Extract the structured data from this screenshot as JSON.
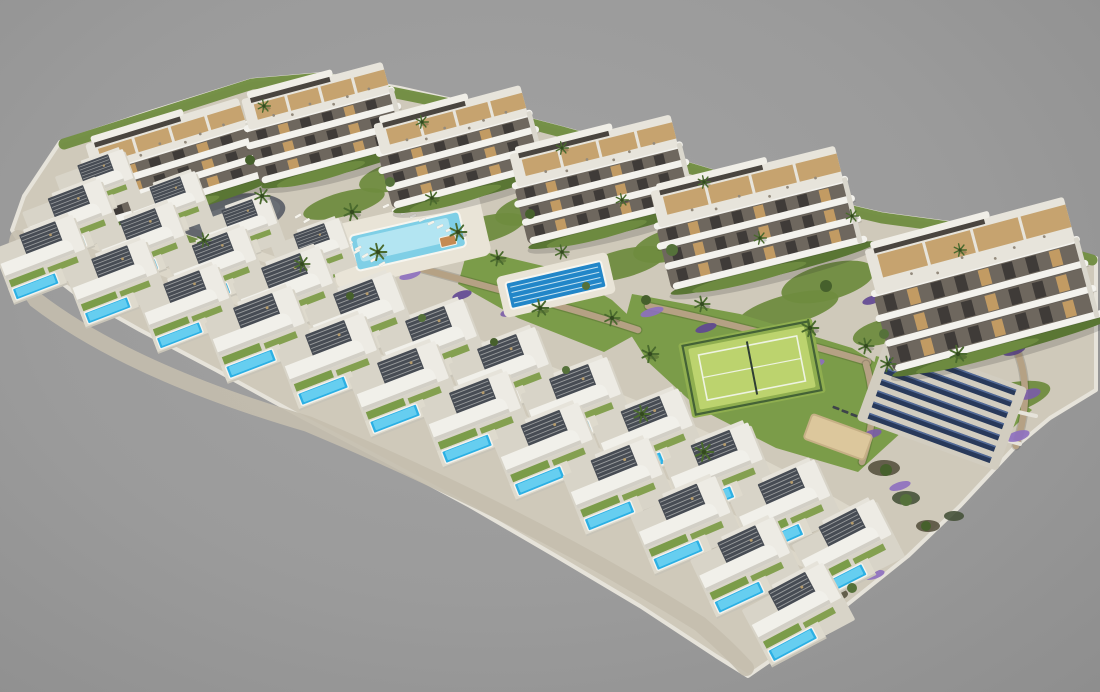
{
  "scene": {
    "description": "Aerial 3D architectural render of a hillside residential development on a plain gray backdrop: six curved white apartment buildings in a diagonal row, two long staircased arcs of white villas each with a private blue pool and dark slatted pergola, a communal free-form pool with sun loungers, a dark-blue lap pool, a fenced padel tennis court on a lawn, a gray playground oval with colorful equipment, a sand petanque area and a field of dark solar panels at the right",
    "background": {
      "center": "#a3a3a3",
      "mid": "#9b9b9b",
      "edge": "#8e8e8e"
    },
    "palette": {
      "land": "#cfc9ba",
      "land_edge": "#e6e3da",
      "cliff": "#c4beae",
      "building_white": "#f3f2ed",
      "building_facade": "#6e675e",
      "glass": "#3f3b38",
      "wood": "#c29b63",
      "roof_deck": "#e7e4db",
      "hedge": "#5a7634",
      "hedge_light": "#6d8a40",
      "lawn": "#7b9c49",
      "garden": "#6f8c3f",
      "palm": "#4a6a2e",
      "palm_dark": "#33491f",
      "villa_white": "#f1f0ea",
      "villa_shade": "#d2cfc6",
      "villa_wing": "#edebe4",
      "pergola": "#474c54",
      "plot": "#d8d4c8",
      "deck": "#e9e4d7",
      "pool": "#2cb0e4",
      "pool_light": "#71d3f2",
      "main_pool": "#7fcfe6",
      "main_pool_light": "#bce9f3",
      "lap_pool": "#2286c8",
      "lap_pool_lane": "#dff2f8",
      "stone_wall": "#b5a184",
      "path": "#ddd8cb",
      "lavender": [
        "#7a5ca8",
        "#8d6fc0",
        "#5f4694"
      ],
      "tennis_court": "#bcd36e",
      "tennis_runoff": "#8fae4f",
      "tennis_fence": "#3c5a33",
      "court_line": "#eef3e2",
      "sand": "#dcc79c",
      "sand_edge": "#c6b086",
      "solar": "#28395a",
      "solar_hl": "#5d77a8",
      "solar_pad": "#d2cdc0",
      "playground": "#63666d",
      "playground_light": "#70747c",
      "rock1": "#57523f",
      "rock2": "#46523a",
      "shadow": "rgba(40,40,40,0.18)",
      "cabana_roof": "#c58a52"
    },
    "land_outline": [
      [
        60,
        142
      ],
      [
        150,
        112
      ],
      [
        252,
        80
      ],
      [
        322,
        74
      ],
      [
        400,
        88
      ],
      [
        470,
        104
      ],
      [
        562,
        128
      ],
      [
        642,
        150
      ],
      [
        762,
        186
      ],
      [
        882,
        214
      ],
      [
        1002,
        230
      ],
      [
        1096,
        258
      ],
      [
        1096,
        390
      ],
      [
        1050,
        418
      ],
      [
        1014,
        448
      ],
      [
        960,
        506
      ],
      [
        908,
        556
      ],
      [
        838,
        612
      ],
      [
        774,
        658
      ],
      [
        748,
        676
      ],
      [
        716,
        656
      ],
      [
        640,
        606
      ],
      [
        556,
        556
      ],
      [
        470,
        506
      ],
      [
        384,
        460
      ],
      [
        300,
        416
      ],
      [
        216,
        370
      ],
      [
        140,
        330
      ],
      [
        76,
        294
      ],
      [
        30,
        258
      ],
      [
        12,
        230
      ],
      [
        24,
        196
      ]
    ],
    "cliff_path": "M18,238 Q10,262 36,300 Q130,372 308,424 Q528,516 700,624 Q728,648 746,668",
    "top_hedge": "M64,144 L252,84 L322,78 L470,108 L562,132 L642,154 L762,190 L882,218 L1002,234 L1092,260",
    "buildings": [
      [
        92,
        116,
        166,
        98,
        -17
      ],
      [
        248,
        76,
        152,
        102,
        -15
      ],
      [
        380,
        100,
        158,
        102,
        -15
      ],
      [
        516,
        130,
        172,
        108,
        -14
      ],
      [
        658,
        164,
        196,
        118,
        -14
      ],
      [
        876,
        218,
        212,
        146,
        -15
      ]
    ],
    "villas": [
      [
        98,
        186,
        -20,
        0.78
      ],
      [
        170,
        208,
        -20,
        0.78
      ],
      [
        242,
        231,
        -20,
        0.78
      ],
      [
        314,
        255,
        -20,
        0.78
      ],
      [
        72,
        222,
        -21,
        0.9
      ],
      [
        144,
        245,
        -21,
        0.9
      ],
      [
        216,
        269,
        -21,
        0.9
      ],
      [
        288,
        294,
        -21,
        1
      ],
      [
        360,
        320,
        -21,
        1
      ],
      [
        432,
        347,
        -21,
        1
      ],
      [
        504,
        375,
        -21,
        1
      ],
      [
        576,
        405,
        -21,
        1
      ],
      [
        648,
        437,
        -22,
        1
      ],
      [
        718,
        471,
        -22,
        1
      ],
      [
        786,
        509,
        -24,
        1
      ],
      [
        848,
        550,
        -27,
        1
      ],
      [
        44,
        259,
        -21,
        0.92
      ],
      [
        116,
        283,
        -21,
        0.92
      ],
      [
        188,
        308,
        -21,
        0.92
      ],
      [
        260,
        334,
        -21,
        1
      ],
      [
        332,
        361,
        -21,
        1
      ],
      [
        404,
        389,
        -21,
        1
      ],
      [
        476,
        419,
        -21,
        1
      ],
      [
        548,
        451,
        -22,
        1
      ],
      [
        618,
        486,
        -22,
        1
      ],
      [
        686,
        525,
        -23,
        1
      ],
      [
        746,
        567,
        -25,
        1
      ],
      [
        798,
        614,
        -28,
        1
      ]
    ],
    "paths": [
      "M104,202 Q240,248 354,290",
      "M82,240 Q360,346 642,472 Q724,510 802,562",
      "M138,232 Q416,314 638,406 Q760,458 868,522"
    ],
    "walls": [
      "M128,244 Q400,330 620,424 Q742,478 858,542",
      "M300,236 Q420,268 522,296 Q584,312 638,330",
      "M648,306 Q760,330 868,362",
      "M1006,330 Q1038,378 1016,446",
      "M866,364 Q880,410 862,462"
    ],
    "white_walls": [
      "M884,366 Q960,400 1036,416",
      "M872,390 Q950,424 1020,444"
    ],
    "lawns": [
      {
        "type": "poly",
        "pts": [
          [
            632,
            294
          ],
          [
            740,
            314
          ],
          [
            852,
            348
          ],
          [
            900,
            378
          ],
          [
            904,
            430
          ],
          [
            858,
            472
          ],
          [
            776,
            448
          ],
          [
            698,
            408
          ],
          [
            648,
            362
          ],
          [
            624,
            324
          ]
        ]
      },
      {
        "type": "poly",
        "pts": [
          [
            468,
            248
          ],
          [
            560,
            270
          ],
          [
            612,
            300
          ],
          [
            644,
            330
          ],
          [
            604,
            352
          ],
          [
            518,
            318
          ],
          [
            458,
            284
          ]
        ]
      },
      {
        "type": "poly",
        "pts": [
          [
            876,
            356
          ],
          [
            1000,
            388
          ],
          [
            1032,
            410
          ],
          [
            1002,
            438
          ],
          [
            926,
            416
          ],
          [
            868,
            388
          ]
        ]
      },
      {
        "type": "ellipse",
        "cx": 334,
        "cy": 262,
        "rx": 44,
        "ry": 15,
        "rot": -15
      }
    ],
    "gardens": [
      [
        256,
        152,
        38,
        14
      ],
      [
        396,
        176,
        38,
        14
      ],
      [
        534,
        208,
        40,
        15
      ],
      [
        674,
        244,
        42,
        16
      ],
      [
        828,
        282,
        48,
        18
      ],
      [
        882,
        332,
        30,
        12
      ],
      [
        198,
        228,
        44,
        13
      ],
      [
        344,
        204,
        42,
        12
      ],
      [
        482,
        230,
        44,
        13
      ],
      [
        622,
        264,
        46,
        14
      ],
      [
        788,
        310,
        52,
        15
      ],
      [
        996,
        402,
        56,
        16
      ]
    ],
    "lavender": [
      [
        140,
        252,
        14,
        5,
        0
      ],
      [
        198,
        269,
        12,
        4,
        1
      ],
      [
        256,
        288,
        14,
        5,
        2
      ],
      [
        314,
        307,
        12,
        4,
        0
      ],
      [
        372,
        327,
        13,
        5,
        1
      ],
      [
        430,
        348,
        12,
        4,
        2
      ],
      [
        488,
        371,
        14,
        5,
        0
      ],
      [
        546,
        395,
        12,
        4,
        1
      ],
      [
        602,
        420,
        13,
        5,
        2
      ],
      [
        658,
        447,
        12,
        4,
        0
      ],
      [
        714,
        477,
        13,
        5,
        1
      ],
      [
        768,
        508,
        12,
        4,
        2
      ],
      [
        822,
        541,
        13,
        5,
        0
      ],
      [
        874,
        575,
        11,
        4,
        1
      ],
      [
        306,
        238,
        11,
        4,
        2
      ],
      [
        358,
        256,
        10,
        4,
        0
      ],
      [
        410,
        275,
        11,
        4,
        1
      ],
      [
        462,
        295,
        10,
        4,
        2
      ],
      [
        510,
        312,
        10,
        4,
        0
      ],
      [
        652,
        312,
        12,
        4,
        1
      ],
      [
        706,
        328,
        11,
        4,
        2
      ],
      [
        760,
        346,
        12,
        4,
        0
      ],
      [
        814,
        364,
        11,
        4,
        1
      ],
      [
        1014,
        350,
        12,
        5,
        2
      ],
      [
        1030,
        394,
        11,
        5,
        0
      ],
      [
        1018,
        436,
        12,
        5,
        1
      ],
      [
        880,
        390,
        10,
        4,
        2
      ],
      [
        872,
        434,
        10,
        4,
        0
      ],
      [
        900,
        486,
        11,
        4,
        1
      ],
      [
        872,
        300,
        10,
        4,
        2
      ],
      [
        930,
        318,
        10,
        4,
        0
      ]
    ],
    "amenities": {
      "playground": {
        "cx": 232,
        "cy": 216,
        "rx": 54,
        "ry": 21,
        "rot": -10,
        "equipment_colors": [
          "#e0b13c",
          "#d96c2f",
          "#4a8fd4",
          "#c94f4f",
          "#7fb548"
        ]
      },
      "main_pool": {
        "cx": 408,
        "cy": 241,
        "w": 112,
        "h": 36,
        "rot": -13,
        "deck_w": 158,
        "deck_h": 64
      },
      "cabana": {
        "cx": 447,
        "cy": 250,
        "w": 16,
        "h": 10,
        "rot": -13
      },
      "lap_pool": {
        "cx": 556,
        "cy": 285,
        "w": 98,
        "h": 27,
        "rot": -13,
        "deck_w": 114,
        "deck_h": 42,
        "lanes": 4
      },
      "tennis_court": {
        "cx": 752,
        "cy": 368,
        "w": 118,
        "h": 62,
        "rot": -11
      },
      "petanque": {
        "cx": 838,
        "cy": 437,
        "w": 64,
        "h": 26,
        "rot": 20
      },
      "solar_array": {
        "cx": 942,
        "cy": 404,
        "w": 150,
        "h": 88,
        "rot": 20,
        "rows": 7
      }
    },
    "lounger_rows": [
      {
        "x": 298,
        "y": 216,
        "n": 8,
        "dx": 8.6,
        "dy": 4.6,
        "rot": -30,
        "color": "#f6f4ec"
      },
      {
        "x": 386,
        "y": 206,
        "n": 9,
        "dx": 9,
        "dy": 3.4,
        "rot": -25,
        "color": "#f6f4ec"
      },
      {
        "x": 340,
        "y": 243,
        "n": 6,
        "dx": 8.4,
        "dy": 4.2,
        "rot": -30,
        "color": "#f6f4ec"
      },
      {
        "x": 836,
        "y": 408,
        "n": 5,
        "dx": 9,
        "dy": 3.6,
        "rot": 20,
        "color": "#3e434b"
      }
    ],
    "trees": [
      [
        352,
        212,
        1.2
      ],
      [
        378,
        252,
        1.2
      ],
      [
        302,
        264,
        1.1
      ],
      [
        458,
        232,
        1.2
      ],
      [
        498,
        258,
        1.1
      ],
      [
        540,
        308,
        1.2
      ],
      [
        562,
        252,
        1
      ],
      [
        612,
        318,
        1.1
      ],
      [
        432,
        198,
        1
      ],
      [
        262,
        196,
        1.1
      ],
      [
        204,
        240,
        1
      ],
      [
        650,
        354,
        1.2
      ],
      [
        702,
        304,
        1.1
      ],
      [
        810,
        328,
        1.2
      ],
      [
        866,
        346,
        1.1
      ],
      [
        642,
        414,
        1.2
      ],
      [
        704,
        452,
        1.3
      ],
      [
        958,
        354,
        1.2
      ],
      [
        888,
        364,
        1.1
      ],
      [
        264,
        106,
        0.9
      ],
      [
        422,
        122,
        0.9
      ],
      [
        562,
        148,
        0.9
      ],
      [
        704,
        182,
        0.9
      ],
      [
        852,
        216,
        0.9
      ],
      [
        960,
        250,
        0.9
      ],
      [
        622,
        200,
        0.9
      ],
      [
        760,
        238,
        0.9
      ]
    ],
    "bushes": [
      [
        250,
        160,
        5
      ],
      [
        390,
        182,
        5
      ],
      [
        530,
        214,
        5
      ],
      [
        672,
        250,
        6
      ],
      [
        826,
        286,
        6
      ],
      [
        884,
        334,
        5
      ],
      [
        646,
        300,
        5
      ],
      [
        586,
        286,
        4
      ],
      [
        350,
        296,
        4
      ],
      [
        422,
        318,
        4
      ],
      [
        494,
        342,
        4
      ],
      [
        566,
        370,
        4
      ],
      [
        886,
        470,
        6
      ],
      [
        906,
        500,
        6
      ],
      [
        926,
        526,
        5
      ],
      [
        852,
        588,
        5
      ]
    ],
    "rocks": [
      [
        884,
        468,
        16,
        8
      ],
      [
        906,
        498,
        14,
        7
      ],
      [
        928,
        526,
        12,
        6
      ],
      [
        862,
        560,
        12,
        6
      ],
      [
        836,
        594,
        12,
        6
      ],
      [
        954,
        516,
        10,
        5
      ]
    ]
  }
}
